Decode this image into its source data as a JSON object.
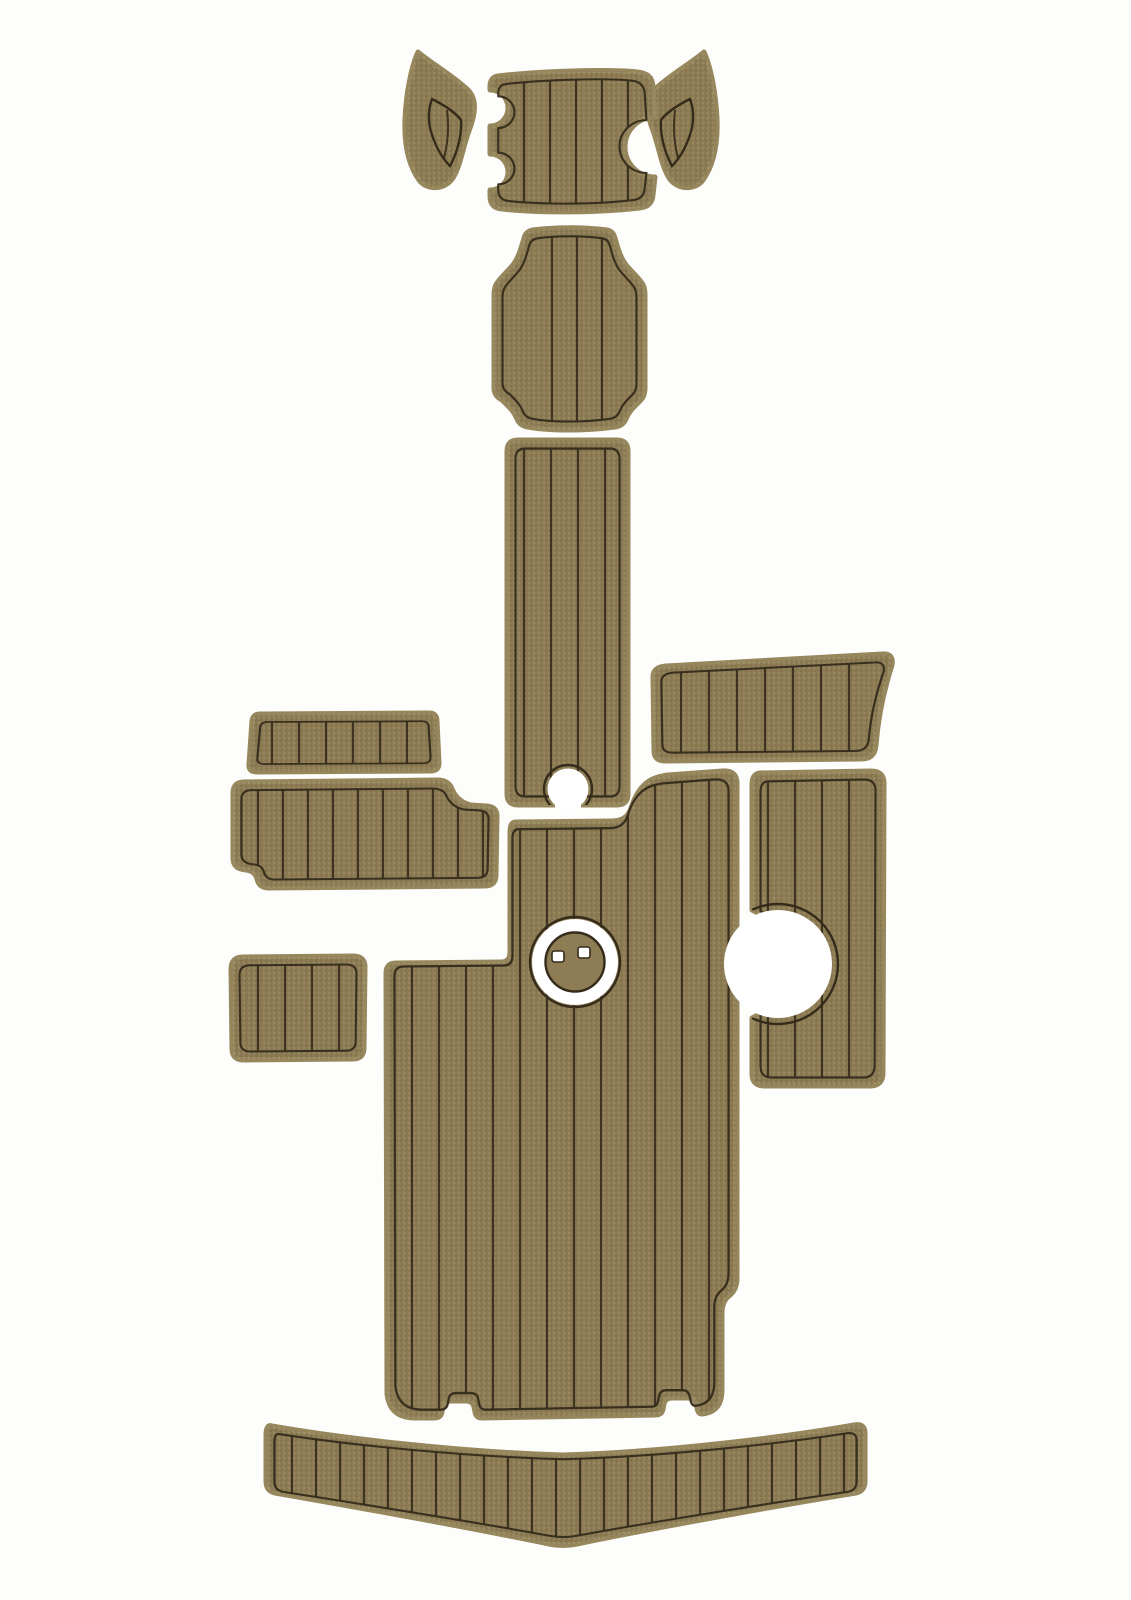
{
  "image": {
    "description": "Product photo of a multi-piece EVA foam faux-teak boat decking pad kit laid out on a white background, brown pads with black caulking grooves",
    "colors": {
      "background": "#fdfdfc",
      "pad_fill": "#8d7c54",
      "pad_bevel": "#97875d",
      "groove": "#352b1b",
      "cutout_white": "#ffffff"
    },
    "pieces": [
      {
        "name": "bow-corner-pad-left",
        "planks": 1,
        "features": [
          "curved horn shape"
        ]
      },
      {
        "name": "bow-hatch-pad",
        "planks": 5,
        "features": [
          "large cup notch on right edge",
          "two notches on left edge"
        ]
      },
      {
        "name": "bow-corner-pad-right",
        "planks": 1,
        "features": [
          "curved horn shape mirrored"
        ]
      },
      {
        "name": "helm-step-pad",
        "planks": 3,
        "features": [
          "plaque shape with concave corners"
        ]
      },
      {
        "name": "walkway-pad",
        "planks": 4,
        "features": [
          "keyhole notch on bottom edge"
        ]
      },
      {
        "name": "gunwale-pad-right",
        "planks": 7,
        "features": [
          "curved right end"
        ]
      },
      {
        "name": "side-box-pad-left-top",
        "planks": 6,
        "features": [
          "trapezoid"
        ]
      },
      {
        "name": "side-box-pad-left",
        "planks": 10,
        "features": [
          "step on top right corner",
          "small step on bottom left"
        ]
      },
      {
        "name": "cockpit-floor-pad",
        "planks": 12,
        "features": [
          "L-shape",
          "round table-base cutout with insert",
          "two handle notches on bottom edge",
          "step on right edge"
        ]
      },
      {
        "name": "side-deck-pad-right",
        "planks": 4,
        "features": [
          "round pedestal cutout open to left edge"
        ]
      },
      {
        "name": "step-pad-left",
        "planks": 4,
        "features": [
          "rounded rectangle"
        ]
      },
      {
        "name": "swim-platform-pad",
        "planks": 24,
        "features": [
          "wide chevron shape dipping at center"
        ]
      }
    ],
    "table_base_insert": {
      "shape": "round khaki disc inside white ring",
      "dots": 2
    }
  }
}
